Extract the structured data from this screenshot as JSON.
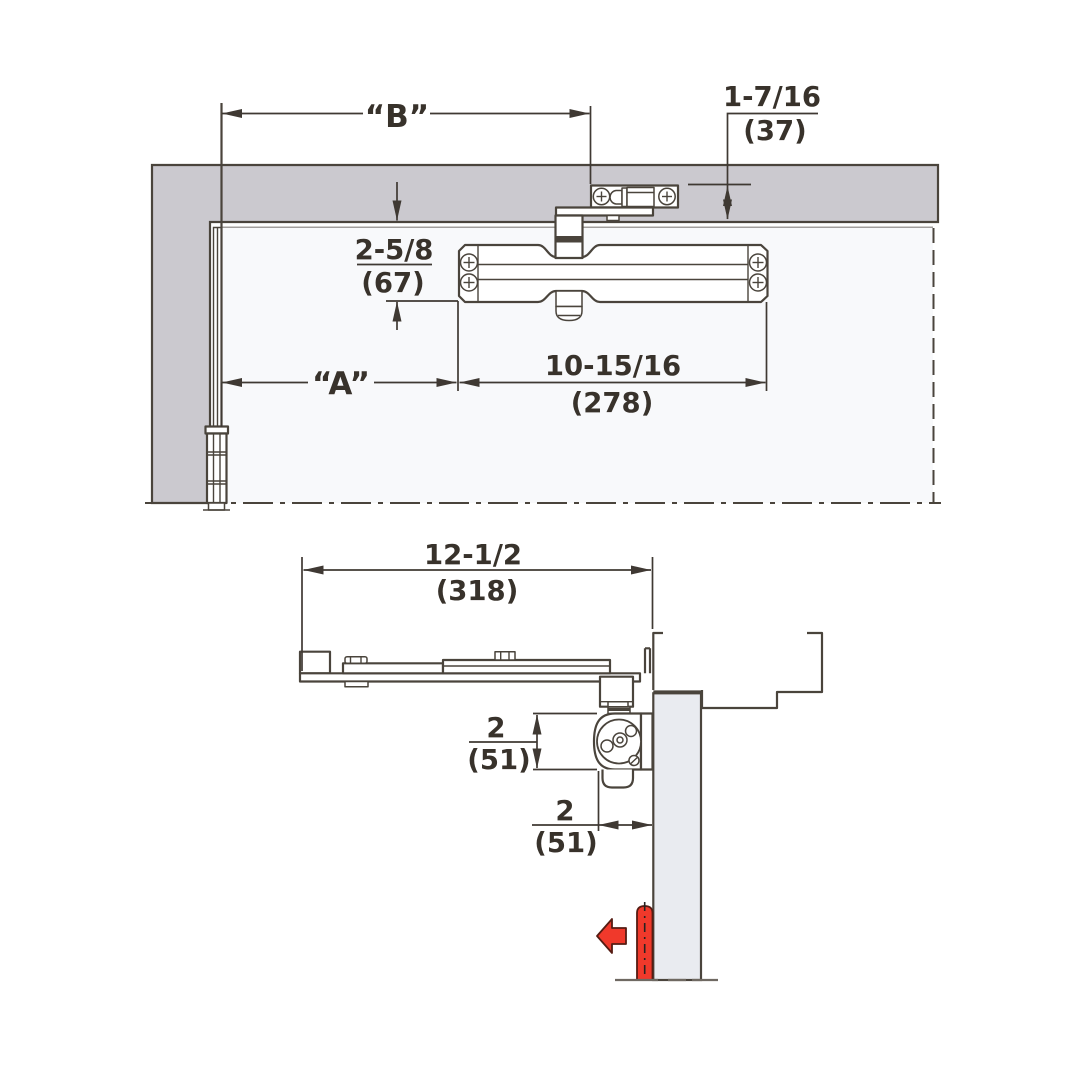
{
  "figure": {
    "type": "technical-drawing",
    "subject": "Door closer mounting dimensions — elevation and plan views"
  },
  "colors": {
    "frame_fill": "#cbc9cf",
    "door_elevation_fill": "#f8f9fb",
    "door_plan_fill": "#e9ebf0",
    "line": "#4a443c",
    "text": "#38322b",
    "accent_red": "#f0392b"
  },
  "elevation": {
    "dim_b_label": "“B”",
    "dim_a_label": "“A”",
    "reveal": {
      "inches": "1-7/16",
      "mm": "(37)"
    },
    "drop": {
      "inches": "2-5/8",
      "mm": "(67)"
    },
    "body_length": {
      "inches": "10-15/16",
      "mm": "(278)"
    }
  },
  "plan": {
    "overall": {
      "inches": "12-1/2",
      "mm": "(318)"
    },
    "projection": {
      "inches": "2",
      "mm": "(51)"
    },
    "offset": {
      "inches": "2",
      "mm": "(51)"
    }
  }
}
